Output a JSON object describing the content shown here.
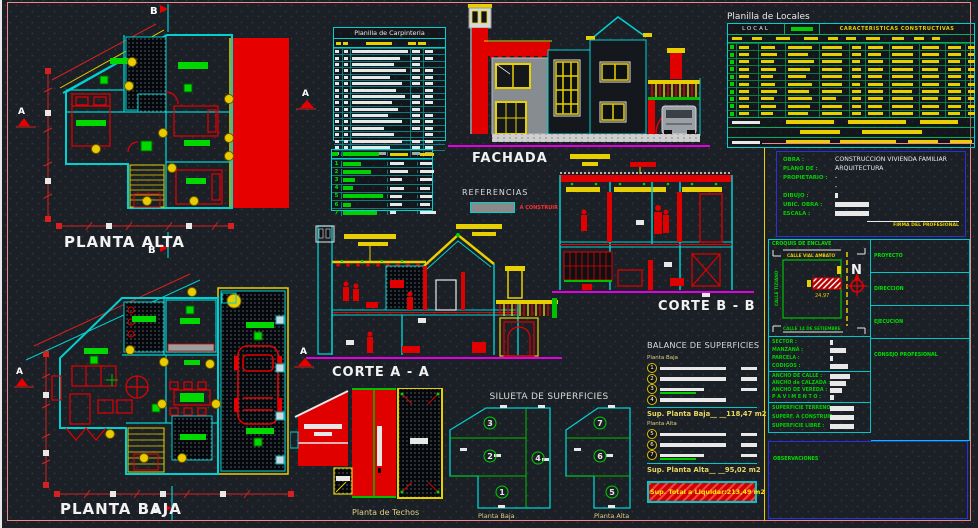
{
  "colors": {
    "cyan": "#00d0d0",
    "red": "#e60000",
    "green": "#00d000",
    "yellow": "#e8d000",
    "magenta": "#e000e0",
    "blue": "#2830e0",
    "pink_frame": "#f08a8a",
    "swatch_gray": "#8a8a8a",
    "white": "#e8e8e8"
  },
  "plans": {
    "planta_alta_title": "PLANTA ALTA",
    "planta_baja_title": "PLANTA BAJA",
    "section_marker_a": "A",
    "section_marker_b": "B"
  },
  "fachada": {
    "title": "FACHADA"
  },
  "cortes": {
    "a_title": "CORTE A - A",
    "b_title": "CORTE B - B"
  },
  "techos": {
    "title": "Planta de Techos"
  },
  "carpinteria": {
    "title": "Planilla de Carpinteria",
    "rows": [
      {
        "w": 56,
        "a": 8,
        "b": 8
      },
      {
        "w": 48,
        "a": 8,
        "b": 8
      },
      {
        "w": 42,
        "a": 8,
        "b": 0
      },
      {
        "w": 54,
        "a": 8,
        "b": 8
      },
      {
        "w": 38,
        "a": 8,
        "b": 8
      },
      {
        "w": 50,
        "a": 8,
        "b": 8
      },
      {
        "w": 44,
        "a": 0,
        "b": 8
      },
      {
        "w": 53,
        "a": 8,
        "b": 8
      },
      {
        "w": 40,
        "a": 8,
        "b": 8
      },
      {
        "w": 46,
        "a": 8,
        "b": 0
      },
      {
        "w": 36,
        "a": 8,
        "b": 8
      },
      {
        "w": 50,
        "a": 8,
        "b": 8
      },
      {
        "w": 32,
        "a": 8,
        "b": 8
      },
      {
        "w": 42,
        "a": 0,
        "b": 8
      },
      {
        "w": 50,
        "a": 8,
        "b": 8
      },
      {
        "w": 38,
        "a": 8,
        "b": 8
      },
      {
        "w": 34,
        "a": 8,
        "b": 8
      }
    ]
  },
  "legend": {
    "rows": [
      {
        "n": "1",
        "lw": 18,
        "b1": 14,
        "b2": 12
      },
      {
        "n": "2",
        "lw": 28,
        "b1": 18,
        "b2": 14
      },
      {
        "n": "3",
        "lw": 12,
        "b1": 12,
        "b2": 12
      },
      {
        "n": "4",
        "lw": 10,
        "b1": 14,
        "b2": 10
      },
      {
        "n": "5",
        "lw": 40,
        "b1": 12,
        "b2": 12
      },
      {
        "n": "6",
        "lw": 8,
        "b1": 12,
        "b2": 10
      },
      {
        "n": "7",
        "lw": 34,
        "b1": 6,
        "b2": 16
      }
    ]
  },
  "referencias": {
    "title": "REFERENCIAS",
    "legend_label": "A CONSTRUIR"
  },
  "locales": {
    "title": "Planilla de Locales",
    "header_local": "LOCAL",
    "header_caracteristicas": "CARACTERISTICAS CONSTRUCTIVAS",
    "rows": [
      {
        "c2": 10,
        "c3": 14,
        "c4": 24,
        "c5": 20,
        "c6": 9,
        "c7": 15,
        "c8": 21,
        "c9": 17,
        "c10": 13,
        "c11": 7
      },
      {
        "c2": 10,
        "c3": 16,
        "c4": 20,
        "c5": 20,
        "c6": 9,
        "c7": 13,
        "c8": 21,
        "c9": 17,
        "c10": 13,
        "c11": 6
      },
      {
        "c2": 10,
        "c3": 13,
        "c4": 26,
        "c5": 20,
        "c6": 8,
        "c7": 15,
        "c8": 21,
        "c9": 17,
        "c10": 12,
        "c11": 7
      },
      {
        "c2": 10,
        "c3": 15,
        "c4": 22,
        "c5": 20,
        "c6": 9,
        "c7": 15,
        "c8": 21,
        "c9": 16,
        "c10": 13,
        "c11": 7
      },
      {
        "c2": 10,
        "c3": 12,
        "c4": 18,
        "c5": 20,
        "c6": 9,
        "c7": 14,
        "c8": 21,
        "c9": 17,
        "c10": 13,
        "c11": 6
      },
      {
        "c2": 10,
        "c3": 14,
        "c4": 24,
        "c5": 20,
        "c6": 8,
        "c7": 15,
        "c8": 21,
        "c9": 17,
        "c10": 12,
        "c11": 7
      },
      {
        "c2": 10,
        "c3": 16,
        "c4": 21,
        "c5": 20,
        "c6": 9,
        "c7": 15,
        "c8": 20,
        "c9": 17,
        "c10": 13,
        "c11": 7
      },
      {
        "c2": 10,
        "c3": 13,
        "c4": 24,
        "c5": 14,
        "c6": 9,
        "c7": 15,
        "c8": 21,
        "c9": 16,
        "c10": 13,
        "c11": 6
      },
      {
        "c2": 10,
        "c3": 15,
        "c4": 22,
        "c5": 20,
        "c6": 9,
        "c7": 14,
        "c8": 21,
        "c9": 17,
        "c10": 13,
        "c11": 7
      },
      {
        "c2": 10,
        "c3": 12,
        "c4": 20,
        "c5": 20,
        "c6": 9,
        "c7": 15,
        "c8": 21,
        "c9": 17,
        "c10": 12,
        "c11": 7
      }
    ]
  },
  "silueta": {
    "title": "SILUETA DE SUPERFICIES",
    "pb_label": "Planta Baja",
    "pa_label": "Planta Alta",
    "pb_numbers": [
      "3",
      "2",
      "1",
      "4"
    ],
    "pa_numbers": [
      "7",
      "6",
      "5"
    ]
  },
  "balance": {
    "title": "BALANCE DE SUPERFICIES",
    "pb_label": "Planta Baja",
    "pa_label": "Planta Alta",
    "pb_rows": [
      {
        "n": "1",
        "bar": 66,
        "tail": 16
      },
      {
        "n": "2",
        "bar": 66,
        "tail": 16
      },
      {
        "n": "3",
        "bar": 44,
        "tail": 16,
        "green": 36
      },
      {
        "n": "4",
        "bar": 66,
        "tail": 0
      }
    ],
    "pa_rows": [
      {
        "n": "5",
        "bar": 66,
        "tail": 16
      },
      {
        "n": "6",
        "bar": 66,
        "tail": 16
      },
      {
        "n": "7",
        "bar": 44,
        "tail": 16,
        "green": 36
      }
    ],
    "pb_total": "Sup. Planta Baja__ __118,47 m2",
    "pa_total": "Sup. Planta Alta__ __95,02 m2",
    "grand_total": "Sup. Total a Liquidar:213,49 m2"
  },
  "titleblock": {
    "obra_label": "OBRA :",
    "obra_value": "CONSTRUCCION VIVIENDA FAMILIAR",
    "plano_label": "PLANO DE :",
    "plano_value": "ARQUITECTURA",
    "propietario_label": "PROPIETARIO :",
    "propietario_value": "-",
    "propietario_value2": "-",
    "dibujo_label": "DIBUJO :",
    "ubic_label": "UBIC. OBRA :",
    "escala_label": "ESCALA :",
    "firma_label": "FIRMA DEL PROFESIONAL",
    "croquis_label": "CROQUIS DE ENCLAVE",
    "north": "N",
    "lot_dim": "24,97",
    "street_top": "CALLE VIAL AMBATO",
    "street_bottom": "CALLE 14 DE SETIEMBRE",
    "street_left": "CALLE TIZIANO",
    "proyecto_label": "PROYECTO",
    "direccion_label": "DIRECCION",
    "ejecucion_label": "EJECUCION",
    "consejo_label": "CONSEJO PROFESIONAL",
    "sector_label": "SECTOR :",
    "manzana_label": "MANZANA :",
    "parcela_label": "PARCELA :",
    "codigos_label": "CODIGOS :",
    "ancho_calle_label": "ANCHO DE CALLE :",
    "ancho_calzada_label": "ANCHO de CALZADA :",
    "ancho_vereda_label": "ANCHO DE VEREDA :",
    "pavimento_label": "P A V I M E N T O :",
    "sup_terreno_label": "SUPERFICIE TERRENO :",
    "sup_construir_label": "SUPERF. A CONSTRUIR :",
    "sup_libre_label": "SUPERFICIE LIBRE :",
    "observaciones_label": "OBSERVACIONES"
  }
}
